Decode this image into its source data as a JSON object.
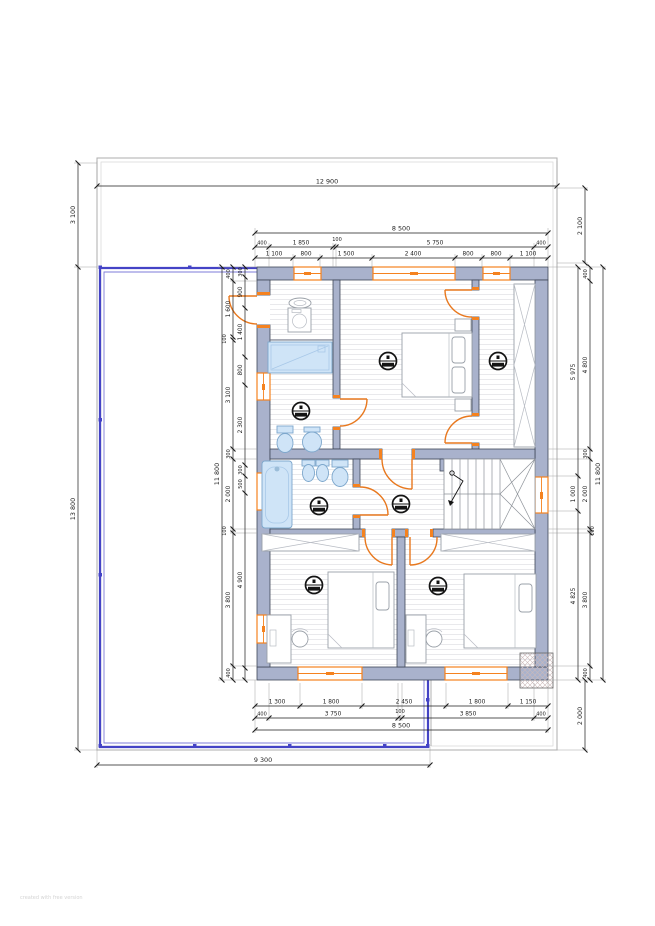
{
  "watermark": "created with free version",
  "colors": {
    "wall_fill": "#a9b2cc",
    "wall_edge": "#3f4757",
    "window_orange": "#f5821f",
    "door_orange": "#e8781e",
    "terrace_purple": "#4443c6",
    "sanitary_blue": "#cfe4f7",
    "roof_gray": "#adadad",
    "dim_black": "#1c1c1c"
  },
  "dims": {
    "top": {
      "overall": "12 900",
      "band": "8 500",
      "chain_a": [
        "400",
        "1 850",
        "100",
        "5 750",
        "400"
      ],
      "chain_b": [
        "1 100",
        "800",
        "1 500",
        "2 400",
        "800",
        "800",
        "1 100"
      ]
    },
    "bottom": {
      "chain_a": [
        "1 300",
        "1 800",
        "2 450",
        "1 800",
        "1 150"
      ],
      "chain_b": [
        "400",
        "3 750",
        "100",
        "3 850",
        "400"
      ],
      "band": "8 500",
      "terrace": "9 300"
    },
    "left": {
      "roof": "3 100",
      "overall": "13 800",
      "inner": "11 800",
      "chain_a": [
        "400",
        "1 600",
        "100",
        "3 100",
        "300",
        "2 000",
        "100",
        "3 800",
        "400"
      ],
      "chain_b": [
        "300",
        "900",
        "1 400",
        "800",
        "2 300",
        "300",
        "500",
        "4 900"
      ]
    },
    "right": {
      "roof_top": "2 100",
      "inner": "11 800",
      "chain_a": [
        "5 975",
        "1 000",
        "4 825"
      ],
      "chain_b": [
        "400",
        "4 800",
        "300",
        "2 000",
        "100",
        "3 800",
        "400"
      ],
      "roof_bottom": "2 000"
    }
  }
}
